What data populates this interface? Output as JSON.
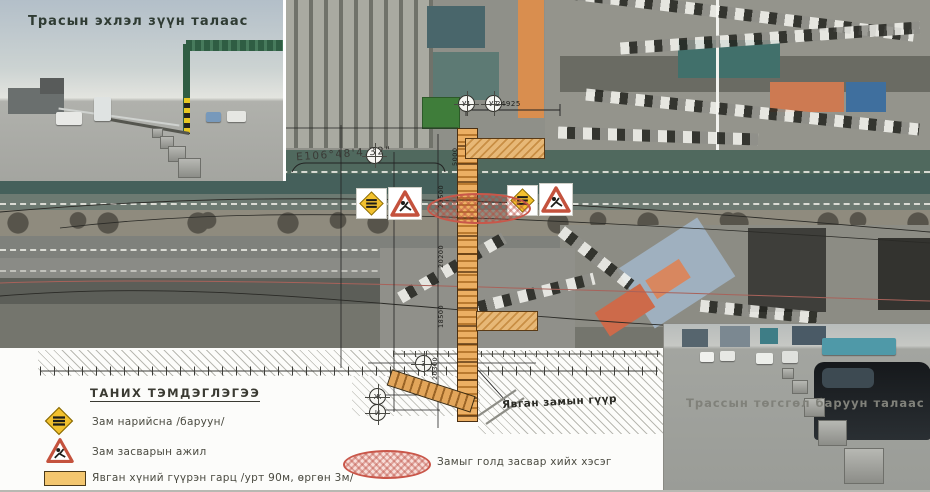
{
  "photos": {
    "top_left_caption": "Трасын эхлэл зүүн талаас",
    "bottom_right_caption": "Трассын төгсгөл баруун талаас"
  },
  "plan": {
    "coordinate_label": "E106°48'4.32\"",
    "bridge_label": "Явган замын гүүр",
    "axis_markers": {
      "u1": "У1",
      "u2": "У2",
      "m3": "3",
      "mzh": "Ж",
      "mi": "И"
    },
    "dimensions": {
      "span_top": "24925",
      "d1": "5000",
      "d2": "21500",
      "d3": "20200",
      "d4": "18500",
      "d5": "20300"
    }
  },
  "legend": {
    "title": "ТАНИХ ТЭМДЭГЛЭГЭЭ",
    "items": [
      {
        "icon": "road-narrows-sign",
        "label": "Зам нарийсна /баруун/"
      },
      {
        "icon": "road-works-sign",
        "label": "Зам засварын ажил"
      },
      {
        "icon": "pedestrian-overpass-bar",
        "label": "Явган хүний гүүрэн гарц /урт 90м, өргөн 3м/"
      },
      {
        "icon": "median-repair-ellipse",
        "label": "Замыг голд засвар хийх хэсэг"
      }
    ]
  },
  "colors": {
    "sign_yellow": "#f2c12e",
    "sign_red": "#c4523d",
    "bridge_orange": "#e0984f",
    "repair_red": "#c9574a"
  }
}
